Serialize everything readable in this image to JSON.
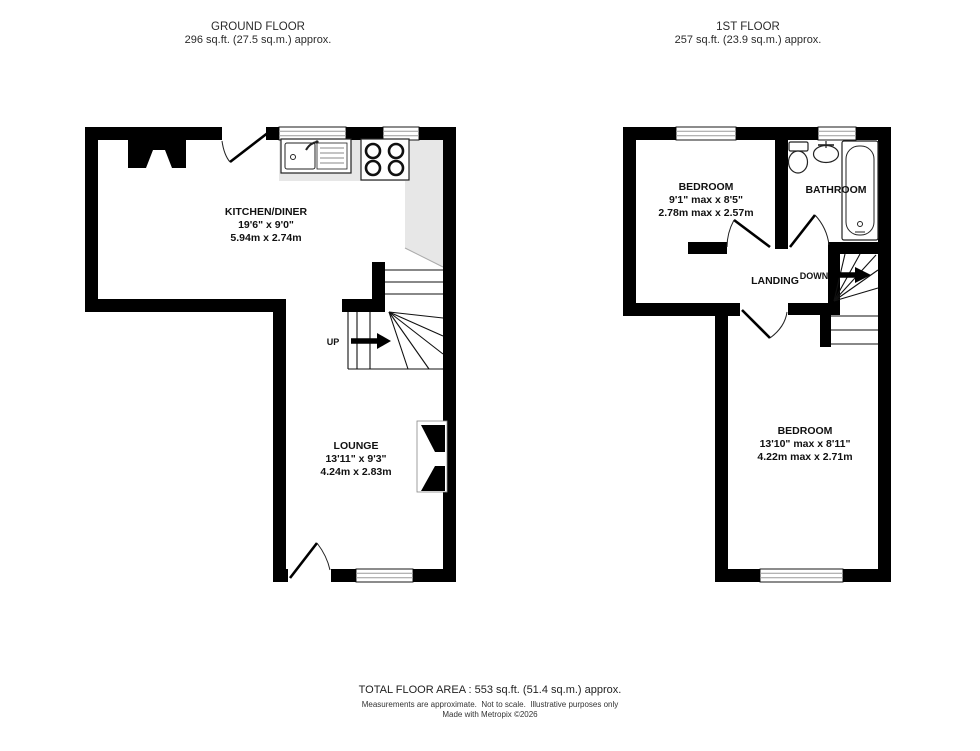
{
  "ground_floor": {
    "header": {
      "title": "GROUND FLOOR",
      "area": "296 sq.ft. (27.5 sq.m.) approx."
    },
    "rooms": {
      "kitchen_diner": {
        "name": "KITCHEN/DINER",
        "dims_imperial": "19'6\" x 9'0\"",
        "dims_metric": "5.94m x 2.74m"
      },
      "lounge": {
        "name": "LOUNGE",
        "dims_imperial": "13'11\" x 9'3\"",
        "dims_metric": "4.24m x 2.83m"
      }
    },
    "stairs_label": "UP"
  },
  "first_floor": {
    "header": {
      "title": "1ST FLOOR",
      "area": "257 sq.ft. (23.9 sq.m.) approx."
    },
    "rooms": {
      "bedroom_front": {
        "name": "BEDROOM",
        "dims_imperial": "9'1\" max x 8'5\"",
        "dims_metric": "2.78m max x 2.57m"
      },
      "bathroom": {
        "name": "BATHROOM"
      },
      "landing": {
        "name": "LANDING"
      },
      "bedroom_back": {
        "name": "BEDROOM",
        "dims_imperial": "13'10\" max x 8'11\"",
        "dims_metric": "4.22m max x 2.71m"
      }
    },
    "stairs_label": "DOWN"
  },
  "footer": {
    "total_area": "TOTAL FLOOR AREA : 553 sq.ft. (51.4 sq.m.) approx.",
    "disclaimer": "Measurements are approximate.  Not to scale.  Illustrative purposes only",
    "credit": "Made with Metropix ©2026"
  },
  "colors": {
    "wall": "#000000",
    "counter": "#e7e7e7",
    "window_line": "#9a9a9a"
  }
}
